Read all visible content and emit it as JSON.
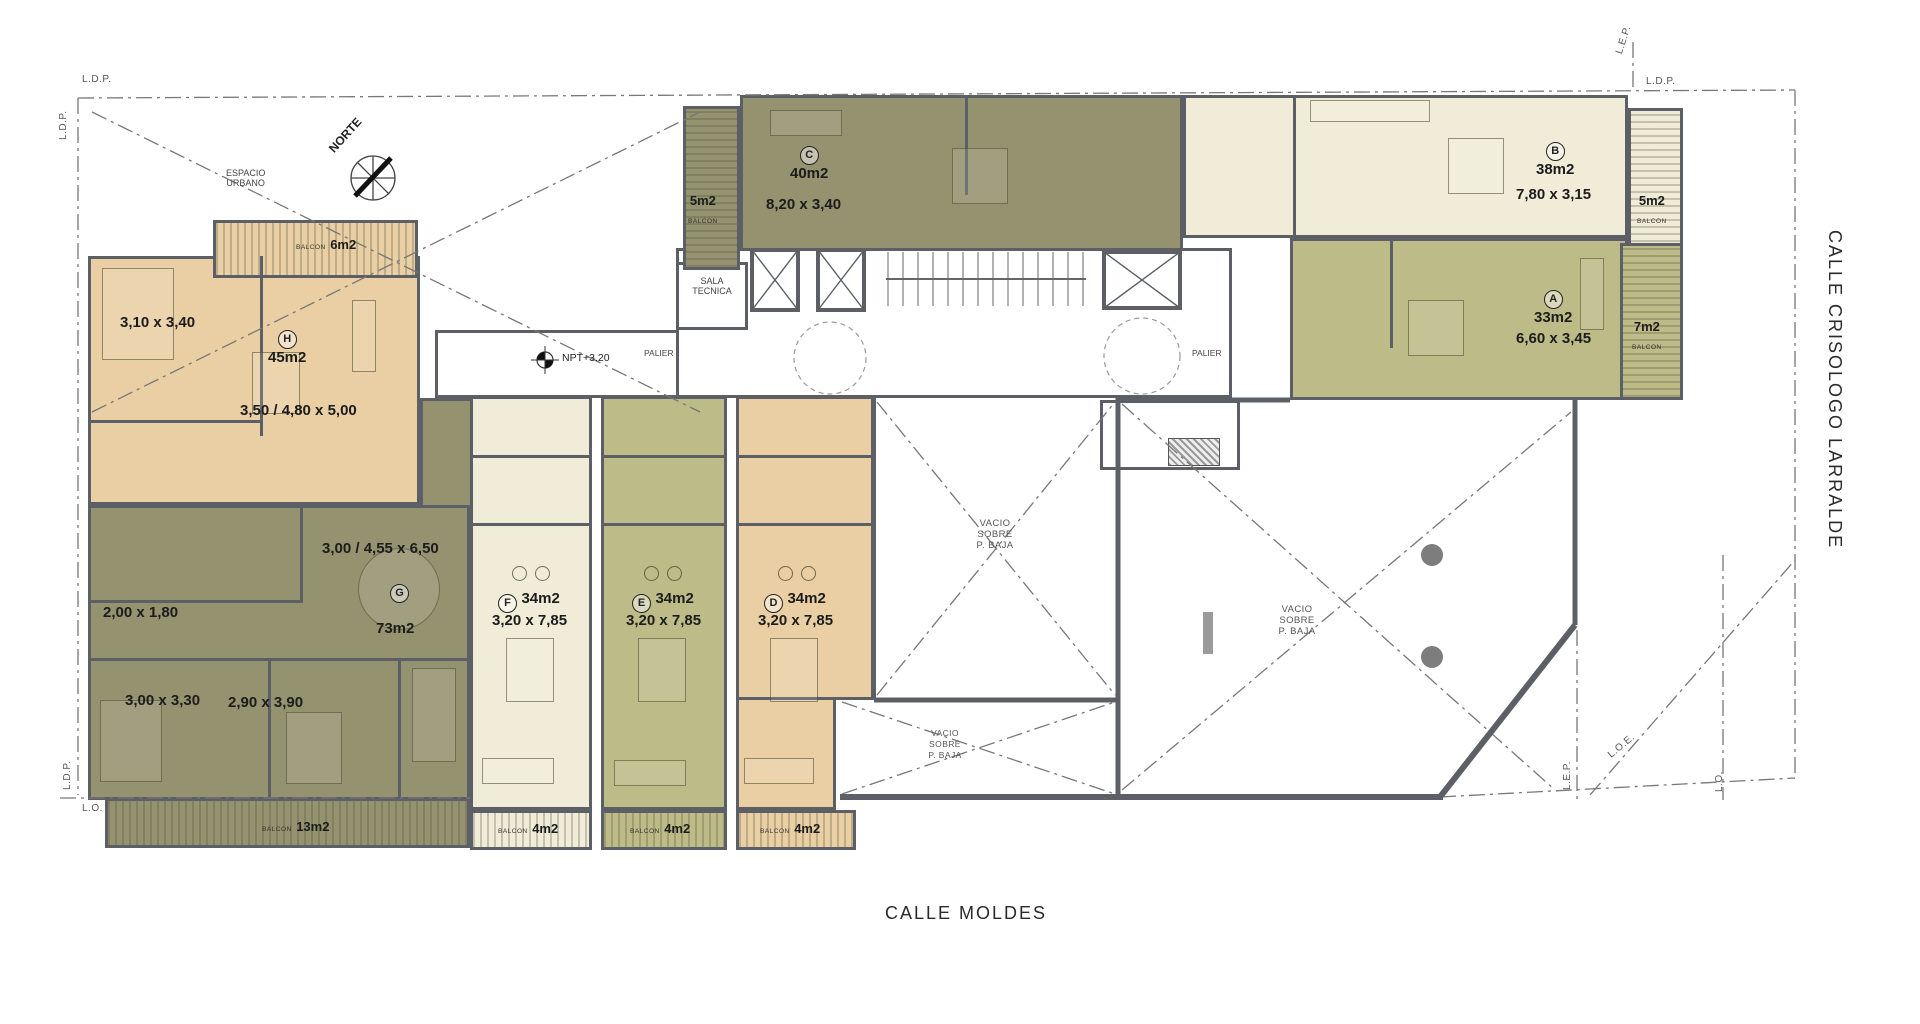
{
  "streets": {
    "bottom": "CALLE MOLDES",
    "right": "CALLE CRISOLOGO LARRALDE"
  },
  "boundary": {
    "ldp": "L.D.P.",
    "lo": "L.O.",
    "lep": "L.E.P.",
    "loe": "L.O.E."
  },
  "common": {
    "north": "NORTE",
    "espacio1": "ESPACIO",
    "espacio2": "URBANO",
    "sala1": "SALA",
    "sala2": "TECNICA",
    "palier": "PALIER",
    "npt": "NPT+3.20",
    "vacio1": "VACIO",
    "vacio2": "SOBRE",
    "vacio3": "P. BAJA",
    "balcon": "BALCON"
  },
  "units": {
    "A": {
      "letter": "A",
      "area": "33m2",
      "dim": "6,60 x 3,45",
      "balcony": "7m2"
    },
    "B": {
      "letter": "B",
      "area": "38m2",
      "dim": "7,80 x 3,15",
      "balcony": "5m2"
    },
    "C": {
      "letter": "C",
      "area": "40m2",
      "dim": "8,20 x 3,40",
      "balcony": "5m2"
    },
    "D": {
      "letter": "D",
      "area": "34m2",
      "dim": "3,20 x 7,85",
      "balcony": "4m2"
    },
    "E": {
      "letter": "E",
      "area": "34m2",
      "dim": "3,20 x 7,85",
      "balcony": "4m2"
    },
    "F": {
      "letter": "F",
      "area": "34m2",
      "dim": "3,20 x 7,85",
      "balcony": "4m2"
    },
    "G": {
      "letter": "G",
      "area": "73m2",
      "dim": "3,00 / 4,55 x 6,50",
      "dim2": "2,00 x 1,80",
      "dim3": "3,00 x 3,30",
      "dim4": "2,90 x 3,90",
      "balcony": "13m2"
    },
    "H": {
      "letter": "H",
      "area": "45m2",
      "dim": "3,50 / 4,80 x 5,00",
      "dim2": "3,10 x 3,40",
      "balcony": "6m2"
    }
  },
  "colors": {
    "tan": "#e9cfa3",
    "olive": "#94926f",
    "cream": "#f0ecd8",
    "khaki": "#bdbb87",
    "wall": "#5c6066"
  }
}
